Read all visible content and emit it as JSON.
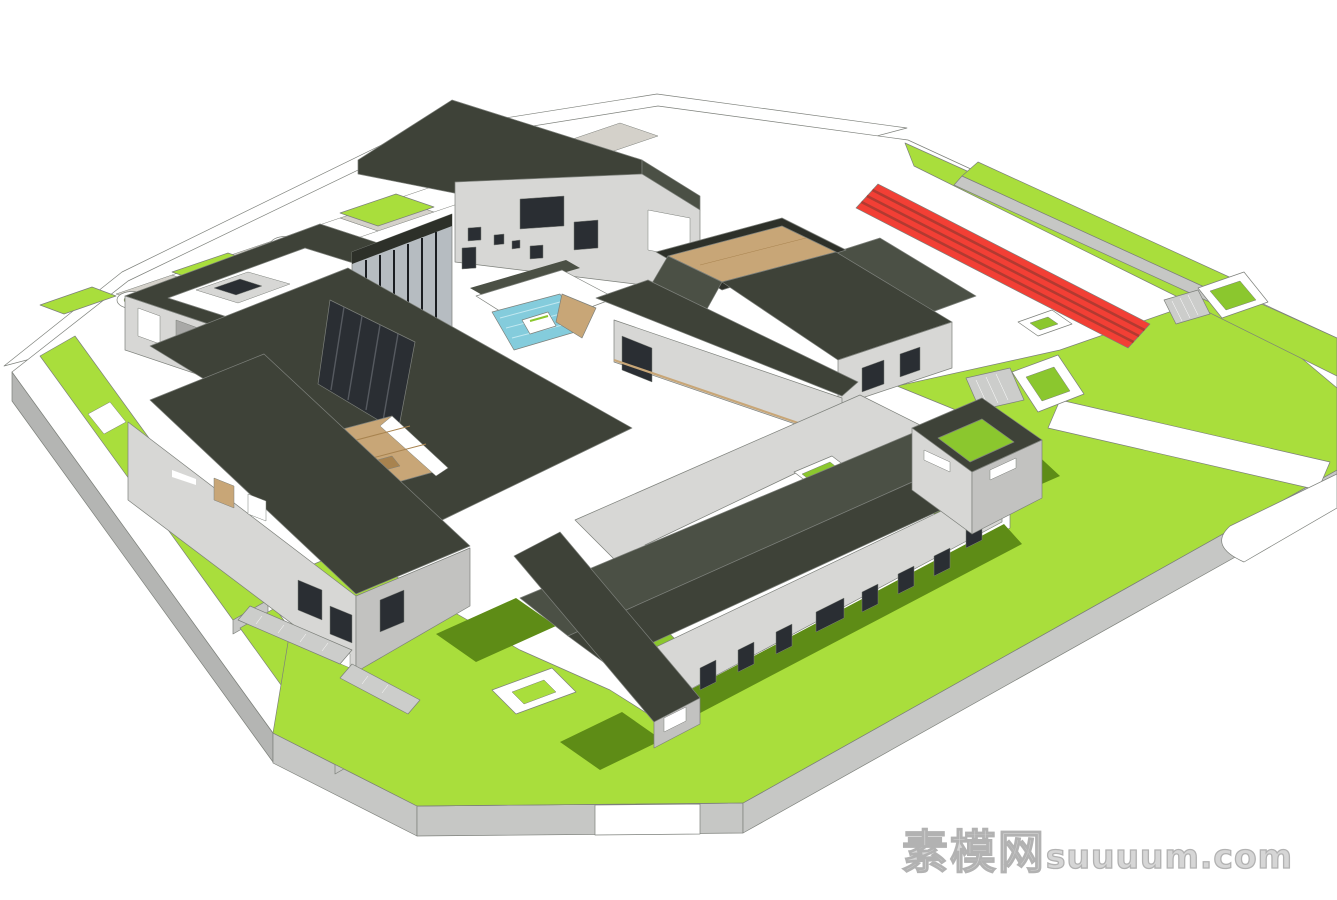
{
  "watermark": {
    "cn": "素模网",
    "latin": "suuuum.com"
  },
  "colors": {
    "bg": "#ffffff",
    "white": "#ffffff",
    "outline": "#8a8c89",
    "plate_side": "#c6c7c5",
    "plate_side_dark": "#b4b5b3",
    "paver": "#d4d1ca",
    "lawn": "#a9de3c",
    "lawn_shadow": "#5e8c16",
    "grass_deep": "#8bc72e",
    "roof_dark": "#3e4238",
    "roof_mid": "#4b5045",
    "roof_edge": "#2d3029",
    "wall_light": "#d7d7d5",
    "wall_mid": "#c2c2c0",
    "wall_dark": "#a8a8a6",
    "glass": "#b6bcc1",
    "glass_dark": "#2a2e33",
    "mullion": "#1b1e22",
    "wood": "#c8a677",
    "wood_dark": "#a8834f",
    "pool": "#84ccdc",
    "pool_light": "#c2e8f0",
    "track_red": "#f23f35",
    "track_divider": "#b23a31",
    "stair": "#cccdcb"
  }
}
